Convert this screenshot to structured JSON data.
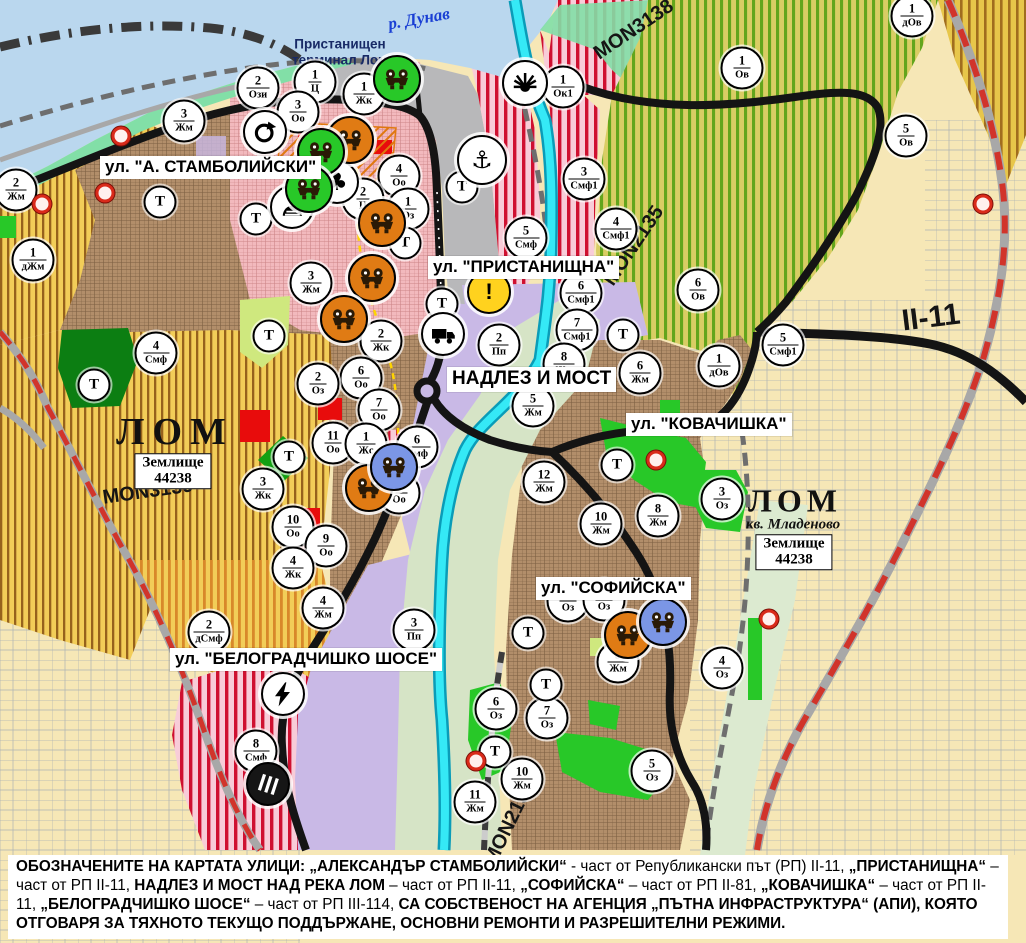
{
  "colors": {
    "water": "#bad7ee",
    "shore": "#82dfa7",
    "port-grey": "#b8b8ba",
    "urban-brown": "#b28e6a",
    "oldtown-pink": "#f2b9bd",
    "agri-yellow": "#f2cd58",
    "agri-stripe": "#96621c",
    "bel-stripe": "#d8882a",
    "ov-base": "#d9cd64",
    "ov-stripe": "#63a51c",
    "corner-base": "#e7c64a",
    "corner-stripe": "#a06d1e",
    "smf-pink": "#f8ccd8",
    "smf-stripe": "#cf1030",
    "farmland": "#f6e7b6",
    "parcel-line": "#9aa4b2",
    "purple": "#c9b9e6",
    "green-bright": "#28c828",
    "green-dark": "#0c7e12",
    "lime": "#cfe87e",
    "red": "#e80c0c",
    "river-cyan": "#35e9f6",
    "river-edge": "#0a9cb8",
    "riverbank": "#d6e4c6",
    "pale-strip": "#dcead0",
    "road-black": "#141414",
    "road-grey": "#a8a8a8",
    "road-red": "#d1342b",
    "yellow-dash": "#ffd400",
    "icon-orange": "#e07b14",
    "icon-green": "#28c828",
    "icon-blue": "#7b96e6",
    "navy": "#182a66",
    "river-label": "#1a3fd4",
    "warning-yellow": "#ffd21e",
    "hatch-orange": "#e0780f"
  },
  "place_labels": [
    {
      "kind": "river",
      "text": "р. Дунав",
      "x": 419,
      "y": 19,
      "rot": -10
    },
    {
      "kind": "port",
      "text": "Пристанищен\nтерминал Лом",
      "x": 340,
      "y": 52,
      "rot": 0
    },
    {
      "kind": "city",
      "text": "ЛОМ",
      "x": 175,
      "y": 432,
      "rot": 0,
      "fs": 38,
      "ls": 8
    },
    {
      "kind": "city",
      "text": "ЛОМ",
      "x": 795,
      "y": 501,
      "rot": 0,
      "fs": 32,
      "ls": 5
    },
    {
      "kind": "district",
      "text": "кв. Младеново",
      "x": 793,
      "y": 525,
      "rot": 0
    }
  ],
  "street_labels": [
    {
      "text": "ул. \"А. СТАМБОЛИЙСКИ\"",
      "x": 100,
      "y": 156,
      "fs": 17
    },
    {
      "text": "ул. \"ПРИСТАНИЩНА\"",
      "x": 428,
      "y": 256,
      "fs": 17
    },
    {
      "text": "НАДЛЕЗ И МОСТ",
      "x": 447,
      "y": 367,
      "fs": 19
    },
    {
      "text": "ул. \"КОВАЧИШКА\"",
      "x": 626,
      "y": 413,
      "fs": 17
    },
    {
      "text": "ул. \"СОФИЙСКА\"",
      "x": 536,
      "y": 577,
      "fs": 17
    },
    {
      "text": "ул. \"БЕЛОГРАДЧИШКО ШОСЕ\"",
      "x": 170,
      "y": 648,
      "fs": 17
    }
  ],
  "road_labels": [
    {
      "text": "MON3139",
      "x": 148,
      "y": 492,
      "rot": -8,
      "fs": 20
    },
    {
      "text": "MON3138",
      "x": 634,
      "y": 30,
      "rot": -34,
      "fs": 20
    },
    {
      "text": "MON2135",
      "x": 634,
      "y": 246,
      "rot": -56,
      "fs": 20
    },
    {
      "text": "MON2136",
      "x": 510,
      "y": 823,
      "rot": -64,
      "fs": 20
    },
    {
      "text": "II-11",
      "x": 931,
      "y": 318,
      "rot": -7,
      "fs": 30
    }
  ],
  "land_boxes": [
    {
      "line1": "Землище",
      "line2": "44238",
      "x": 173,
      "y": 471
    },
    {
      "line1": "Землище",
      "line2": "44238",
      "x": 794,
      "y": 552
    }
  ],
  "t_letter": "Т",
  "zone_markers": [
    {
      "n": "2",
      "c": "Ози",
      "x": 258,
      "y": 88
    },
    {
      "n": "1",
      "c": "Ц",
      "x": 315,
      "y": 82
    },
    {
      "n": "1",
      "c": "Жк",
      "x": 364,
      "y": 94
    },
    {
      "n": "3",
      "c": "Оо",
      "x": 298,
      "y": 112
    },
    {
      "n": "3",
      "c": "Жм",
      "x": 184,
      "y": 121
    },
    {
      "n": "2",
      "c": "Жм",
      "x": 16,
      "y": 190
    },
    {
      "n": "1",
      "c": "Ок1",
      "x": 563,
      "y": 87
    },
    {
      "n": "1",
      "c": "дОв",
      "x": 912,
      "y": 16
    },
    {
      "n": "1",
      "c": "Ов",
      "x": 742,
      "y": 68
    },
    {
      "n": "5",
      "c": "Ов",
      "x": 906,
      "y": 136
    },
    {
      "n": "3",
      "c": "Смф1",
      "x": 584,
      "y": 179
    },
    {
      "n": "4",
      "c": "Оо",
      "x": 399,
      "y": 176
    },
    {
      "n": "2",
      "c": "Ц",
      "x": 363,
      "y": 199
    },
    {
      "n": "1",
      "c": "Оз",
      "x": 408,
      "y": 209
    },
    {
      "n": "4",
      "c": "Смф1",
      "x": 616,
      "y": 229
    },
    {
      "n": "5",
      "c": "Смф",
      "x": 526,
      "y": 238
    },
    {
      "n": "6",
      "c": "Смф1",
      "x": 581,
      "y": 293
    },
    {
      "n": "7",
      "c": "Смф1",
      "x": 577,
      "y": 330
    },
    {
      "n": "6",
      "c": "Ов",
      "x": 698,
      "y": 290
    },
    {
      "n": "5",
      "c": "Смф1",
      "x": 783,
      "y": 345
    },
    {
      "n": "1",
      "c": "дОв",
      "x": 719,
      "y": 366
    },
    {
      "n": "3",
      "c": "Жм",
      "x": 311,
      "y": 283
    },
    {
      "n": "2",
      "c": "Жк",
      "x": 381,
      "y": 341
    },
    {
      "n": "6",
      "c": "Оо",
      "x": 361,
      "y": 378
    },
    {
      "n": "2",
      "c": "Оз",
      "x": 318,
      "y": 384
    },
    {
      "n": "4",
      "c": "Смф",
      "x": 156,
      "y": 353
    },
    {
      "n": "1",
      "c": "дЖм",
      "x": 33,
      "y": 260
    },
    {
      "n": "7",
      "c": "Оо",
      "x": 379,
      "y": 410
    },
    {
      "n": "11",
      "c": "Оо",
      "x": 333,
      "y": 443
    },
    {
      "n": "1",
      "c": "Жс",
      "x": 366,
      "y": 444
    },
    {
      "n": "6",
      "c": "Смф",
      "x": 417,
      "y": 447
    },
    {
      "n": "8",
      "c": "Оо",
      "x": 399,
      "y": 493
    },
    {
      "n": "3",
      "c": "Жк",
      "x": 263,
      "y": 489
    },
    {
      "n": "10",
      "c": "Оо",
      "x": 293,
      "y": 527
    },
    {
      "n": "9",
      "c": "Оо",
      "x": 326,
      "y": 546
    },
    {
      "n": "4",
      "c": "Жк",
      "x": 293,
      "y": 568
    },
    {
      "n": "2",
      "c": "Пп",
      "x": 499,
      "y": 345
    },
    {
      "n": "8",
      "c": "Жм",
      "x": 564,
      "y": 364
    },
    {
      "n": "5",
      "c": "Жм",
      "x": 533,
      "y": 406
    },
    {
      "n": "6",
      "c": "Жм",
      "x": 640,
      "y": 373
    },
    {
      "n": "12",
      "c": "Жм",
      "x": 544,
      "y": 482
    },
    {
      "n": "10",
      "c": "Жм",
      "x": 601,
      "y": 524
    },
    {
      "n": "8",
      "c": "Жм",
      "x": 658,
      "y": 516
    },
    {
      "n": "3",
      "c": "Оз",
      "x": 722,
      "y": 499
    },
    {
      "n": "2",
      "c": "дСмф",
      "x": 209,
      "y": 632
    },
    {
      "n": "4",
      "c": "Жм",
      "x": 323,
      "y": 608
    },
    {
      "n": "3",
      "c": "Пп",
      "x": 414,
      "y": 630
    },
    {
      "n": "8",
      "c": "Смф",
      "x": 256,
      "y": 751
    },
    {
      "n": "8",
      "c": "Оз",
      "x": 568,
      "y": 601
    },
    {
      "n": "10",
      "c": "Оз",
      "x": 604,
      "y": 600
    },
    {
      "n": "9",
      "c": "Жм",
      "x": 618,
      "y": 662
    },
    {
      "n": "4",
      "c": "Оз",
      "x": 722,
      "y": 668
    },
    {
      "n": "6",
      "c": "Оз",
      "x": 496,
      "y": 709
    },
    {
      "n": "7",
      "c": "Оз",
      "x": 547,
      "y": 718
    },
    {
      "n": "5",
      "c": "Оз",
      "x": 652,
      "y": 771
    },
    {
      "n": "10",
      "c": "Жм",
      "x": 522,
      "y": 779
    },
    {
      "n": "11",
      "c": "Жм",
      "x": 475,
      "y": 802
    }
  ],
  "t_markers": [
    {
      "x": 160,
      "y": 202
    },
    {
      "x": 256,
      "y": 219
    },
    {
      "x": 405,
      "y": 243
    },
    {
      "x": 462,
      "y": 187
    },
    {
      "x": 442,
      "y": 304
    },
    {
      "x": 269,
      "y": 336
    },
    {
      "x": 94,
      "y": 385
    },
    {
      "x": 289,
      "y": 457
    },
    {
      "x": 617,
      "y": 465
    },
    {
      "x": 623,
      "y": 335
    },
    {
      "x": 528,
      "y": 633
    },
    {
      "x": 546,
      "y": 685
    },
    {
      "x": 495,
      "y": 752
    }
  ],
  "icons": [
    {
      "type": "anchor",
      "x": 482,
      "y": 160,
      "s": 46,
      "bg": "#ffffff"
    },
    {
      "type": "sun",
      "x": 525,
      "y": 83,
      "s": 42,
      "bg": "#ffffff"
    },
    {
      "type": "circular-arrow",
      "x": 265,
      "y": 132,
      "s": 40,
      "bg": "#ffffff"
    },
    {
      "type": "club",
      "x": 337,
      "y": 182,
      "s": 40,
      "bg": "#ffffff"
    },
    {
      "type": "tunnel",
      "x": 292,
      "y": 207,
      "s": 40,
      "bg": "#ffffff"
    },
    {
      "type": "warning",
      "x": 489,
      "y": 292,
      "s": 40,
      "bg": "#ffd21e"
    },
    {
      "type": "truck",
      "x": 443,
      "y": 334,
      "s": 40,
      "bg": "#ffffff"
    },
    {
      "type": "lightning",
      "x": 283,
      "y": 694,
      "s": 40,
      "bg": "#ffffff"
    },
    {
      "type": "railway",
      "x": 268,
      "y": 784,
      "s": 40,
      "bg": "#161616"
    },
    {
      "type": "mask",
      "x": 350,
      "y": 140,
      "s": 44,
      "bg": "#e07b14"
    },
    {
      "type": "mask",
      "x": 382,
      "y": 223,
      "s": 44,
      "bg": "#e07b14"
    },
    {
      "type": "mask",
      "x": 372,
      "y": 278,
      "s": 44,
      "bg": "#e07b14"
    },
    {
      "type": "mask",
      "x": 344,
      "y": 319,
      "s": 44,
      "bg": "#e07b14"
    },
    {
      "type": "mask",
      "x": 369,
      "y": 488,
      "s": 44,
      "bg": "#e07b14"
    },
    {
      "type": "mask",
      "x": 628,
      "y": 635,
      "s": 44,
      "bg": "#e07b14"
    },
    {
      "type": "mask",
      "x": 397,
      "y": 79,
      "s": 44,
      "bg": "#28c828"
    },
    {
      "type": "mask",
      "x": 321,
      "y": 152,
      "s": 44,
      "bg": "#28c828"
    },
    {
      "type": "mask",
      "x": 309,
      "y": 189,
      "s": 44,
      "bg": "#28c828"
    },
    {
      "type": "mask",
      "x": 394,
      "y": 467,
      "s": 44,
      "bg": "#7b96e6"
    },
    {
      "type": "mask",
      "x": 663,
      "y": 622,
      "s": 44,
      "bg": "#7b96e6"
    }
  ],
  "dots": [
    {
      "x": 121,
      "y": 136
    },
    {
      "x": 105,
      "y": 193
    },
    {
      "x": 42,
      "y": 204
    },
    {
      "x": 656,
      "y": 460
    },
    {
      "x": 769,
      "y": 619
    },
    {
      "x": 476,
      "y": 761
    },
    {
      "x": 983,
      "y": 204
    }
  ],
  "caption": {
    "segments": [
      {
        "t": "ОБОЗНАЧЕНИТЕ НА КАРТАТА УЛИЦИ: „АЛЕКСАНДЪР СТАМБОЛИЙСКИ“",
        "b": true
      },
      {
        "t": " - част от Републикански път (РП) II-11, ",
        "b": false
      },
      {
        "t": "„ПРИСТАНИЩНА“",
        "b": true
      },
      {
        "t": " – част от РП II-11, ",
        "b": false
      },
      {
        "t": "НАДЛЕЗ И МОСТ НАД РЕКА ЛОМ",
        "b": true
      },
      {
        "t": " – част от РП II-11, ",
        "b": false
      },
      {
        "t": "„СОФИЙСКА“",
        "b": true
      },
      {
        "t": " – част от РП II-81, ",
        "b": false
      },
      {
        "t": "„КОВАЧИШКА“",
        "b": true
      },
      {
        "t": " – част от РП II-11, ",
        "b": false
      },
      {
        "t": "„БЕЛОГРАДЧИШКО ШОСЕ“",
        "b": true
      },
      {
        "t": " – част от РП III-114, ",
        "b": false
      },
      {
        "t": "СА СОБСТВЕНОСТ НА АГЕНЦИЯ „ПЪТНА ИНФРАСТРУКТУРА“ (АПИ), КОЯТО ОТГОВАРЯ ЗА ТЯХНОТО ТЕКУЩО ПОДДЪРЖАНЕ, ОСНОВНИ РЕМОНТИ И РАЗРЕШИТЕЛНИ РЕЖИМИ.",
        "b": true
      }
    ]
  }
}
